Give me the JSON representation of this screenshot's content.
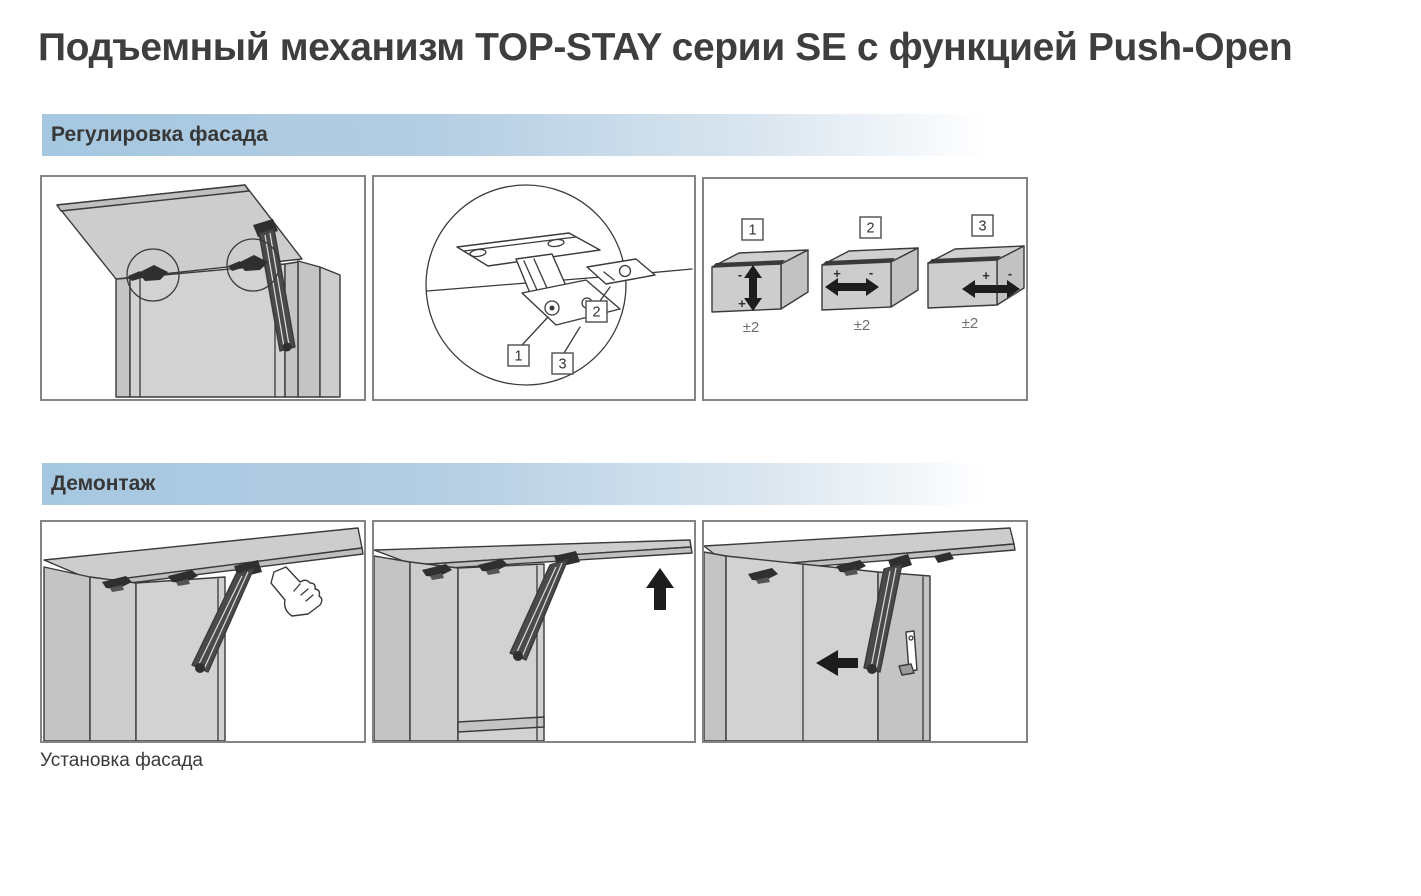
{
  "page": {
    "title": "Подъемный механизм TOP-STAY серии SE с функцией Push-Open",
    "caption_below_panels": "Установка фасада"
  },
  "sections": {
    "adjustment": {
      "header": "Регулировка фасада",
      "hinge_detail": {
        "callout_1": "1",
        "callout_2": "2",
        "callout_3": "3"
      },
      "axes": [
        {
          "label": "1",
          "direction": "vertical",
          "minus": "-",
          "plus": "+",
          "range": "±2"
        },
        {
          "label": "2",
          "direction": "horizontal",
          "minus": "-",
          "plus": "+",
          "range": "±2"
        },
        {
          "label": "3",
          "direction": "depth",
          "minus": "-",
          "plus": "+",
          "range": "±2"
        }
      ]
    },
    "dismantling": {
      "header": "Демонтаж"
    }
  },
  "colors": {
    "section_header_gradient_left": "#a5c7e0",
    "section_header_gradient_right": "#ffffff",
    "panel_border": "#848484",
    "drawing_line": "#3a3a3a",
    "drawing_fill": "#cdcdcd",
    "arrow_black": "#1d1d1d",
    "title_text": "#3e3e3e",
    "muted_text": "#6f6f6f"
  }
}
